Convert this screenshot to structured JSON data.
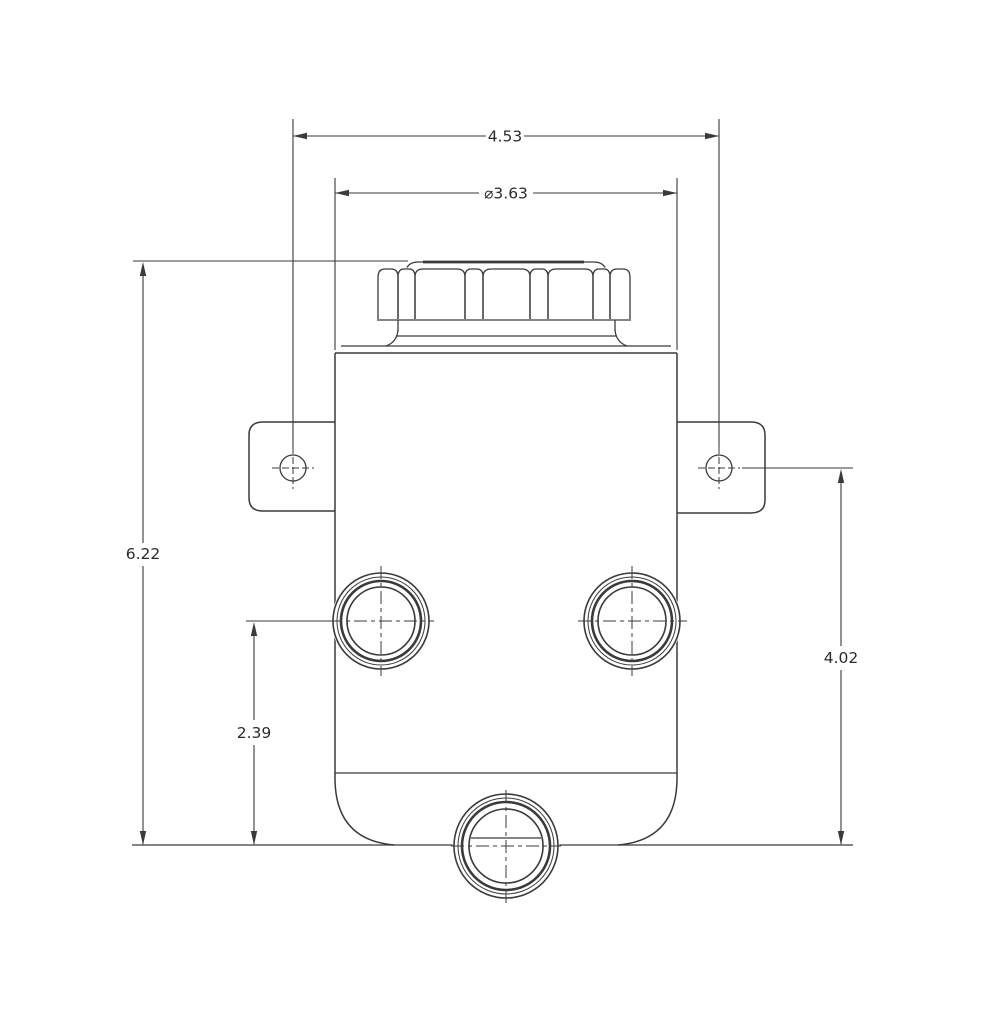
{
  "drawing": {
    "dimensions": {
      "overall_width": "4.53",
      "cap_diameter": "⌀3.63",
      "overall_height": "6.22",
      "port_center_to_base": "2.39",
      "mount_hole_to_base": "4.02"
    },
    "colors": {
      "line": "#3a3a3a",
      "background": "#ffffff"
    }
  }
}
